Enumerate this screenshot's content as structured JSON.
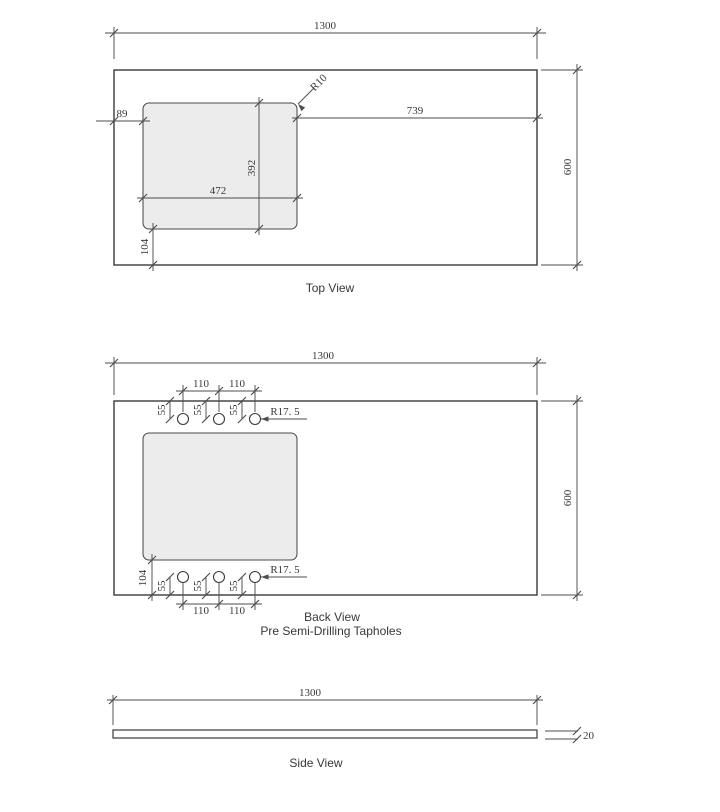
{
  "colors": {
    "outline_color": "#3a3a3a",
    "dim_color": "#4d4d4d",
    "cutout_fill": "#ececec",
    "cutout_stroke": "#4a4a4a",
    "text_color": "#383838",
    "background": "#ffffff"
  },
  "top_view": {
    "title": "Top View",
    "overall_width": "1300",
    "overall_depth": "600",
    "cutout_left_offset": "89",
    "cutout_right_offset": "739",
    "cutout_corner_radius": "R10",
    "cutout_depth": "392",
    "cutout_width": "472",
    "cutout_bottom_offset": "104"
  },
  "back_view": {
    "title": "Back View",
    "subtitle": "Pre Semi-Drilling Tapholes",
    "overall_width": "1300",
    "overall_depth": "600",
    "taphole_spacing_left": "110",
    "taphole_spacing_right": "110",
    "taphole_edge_offset": "55",
    "taphole_radius": "R17. 5",
    "cutout_bottom_offset": "104"
  },
  "side_view": {
    "title": "Side View",
    "overall_width": "1300",
    "thickness": "20"
  }
}
